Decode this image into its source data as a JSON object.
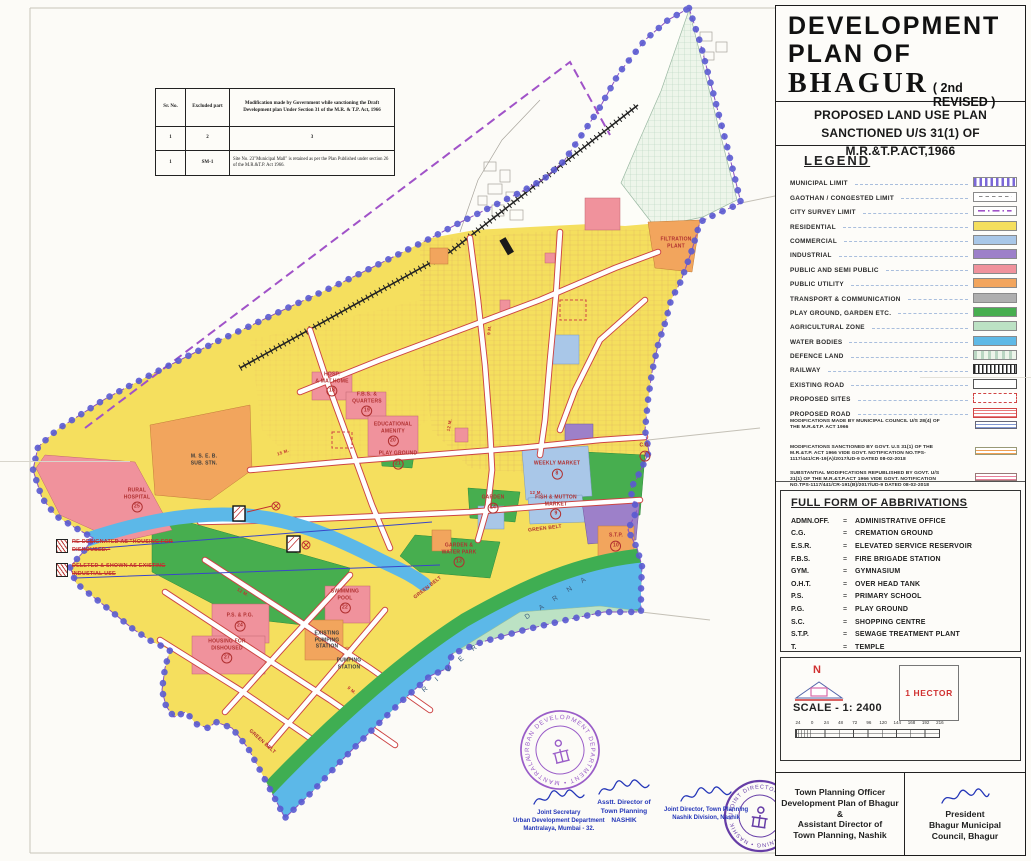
{
  "title_block": {
    "line1": "DEVELOPMENT",
    "line2": "PLAN  OF",
    "name": "BHAGUR",
    "revision": "( 2nd REVISED )",
    "subtitle1": "PROPOSED  LAND USE PLAN",
    "subtitle2": "SANCTIONED U/S 31(1) OF M.R.&T.P.ACT,1966"
  },
  "legend": {
    "title": "LEGEND",
    "items": [
      {
        "label": "MUNICIPAL LIMIT",
        "swatch": "municipal"
      },
      {
        "label": "GAOTHAN / CONGESTED LIMIT",
        "swatch": "gaothan"
      },
      {
        "label": "CITY SURVEY  LIMIT",
        "swatch": "survey"
      },
      {
        "label": "RESIDENTIAL",
        "swatch": "fill",
        "color": "#f5df5e"
      },
      {
        "label": "COMMERCIAL",
        "swatch": "fill",
        "color": "#a9c7e8"
      },
      {
        "label": "INDUSTRIAL",
        "swatch": "fill",
        "color": "#9d80c9"
      },
      {
        "label": "PUBLIC AND SEMI PUBLIC",
        "swatch": "fill",
        "color": "#f0929c"
      },
      {
        "label": "PUBLIC  UTILITY",
        "swatch": "fill",
        "color": "#f2a55d"
      },
      {
        "label": "TRANSPORT &  COMMUNICATION",
        "swatch": "fill",
        "color": "#afafaf"
      },
      {
        "label": "PLAY GROUND, GARDEN ETC.",
        "swatch": "fill",
        "color": "#47ae4f"
      },
      {
        "label": "AGRICULTURAL  ZONE",
        "swatch": "fill",
        "color": "#bce2c4"
      },
      {
        "label": "WATER BODIES",
        "swatch": "fill",
        "color": "#5fb9e6"
      },
      {
        "label": "DEFENCE  LAND",
        "swatch": "defence"
      },
      {
        "label": "RAILWAY",
        "swatch": "railway"
      },
      {
        "label": "EXISTING ROAD",
        "swatch": "existing-road"
      },
      {
        "label": "PROPOSED SITES",
        "swatch": "proposed-sites"
      },
      {
        "label": "PROPOSED ROAD",
        "swatch": "proposed-road"
      },
      {
        "label": "MODIFICATIONS MADE BY MUNICIPAL COUNCIL U/S 28(4) OF THE M.R.&T.P. ACT 1966",
        "swatch": "mod-blue",
        "sz": "small"
      },
      {
        "label": "MODIFICATIONS SANCTIONED BY GOVT. U.S 31(1) OF THE M.R.&T.P. ACT 1966 VIDE GOVT. NOTIFICATION NO.TPS-1117/441/CR-19(A)/2017/UD-9 DATED 08-02-2018",
        "swatch": "mod-orange",
        "sz": "small"
      },
      {
        "label": "SUBSTANTIAL MODIFICATIONS REPUBLISHED BY GOVT. U/S 31(1) OF THE M.R.&T.P.ACT 1966 VIDE GOVT. NOTIFICATION NO.TPS-1117/441/CR-191(B)/2017/UD-9 DATED 08-02-2018",
        "swatch": "mod-pink",
        "sz": "small"
      }
    ]
  },
  "abbreviations": {
    "title": "FULL FORM OF ABBRIVATIONS",
    "items": [
      {
        "abbr": "ADMN.OFF.",
        "eq": "=",
        "full": "ADMINISTRATIVE OFFICE"
      },
      {
        "abbr": "C.G.",
        "eq": "=",
        "full": "CREMATION GROUND"
      },
      {
        "abbr": "E.S.R.",
        "eq": "=",
        "full": "ELEVATED SERVICE RESERVOIR"
      },
      {
        "abbr": "F.B.S.",
        "eq": "=",
        "full": "FIRE BRIGADE STATION"
      },
      {
        "abbr": "GYM.",
        "eq": "=",
        "full": "GYMNASIUM"
      },
      {
        "abbr": "O.H.T.",
        "eq": "=",
        "full": "OVER HEAD TANK"
      },
      {
        "abbr": "P.S.",
        "eq": "=",
        "full": "PRIMARY SCHOOL"
      },
      {
        "abbr": "P.G.",
        "eq": "=",
        "full": "PLAY GROUND"
      },
      {
        "abbr": "S.C.",
        "eq": "=",
        "full": "SHOPPING CENTRE"
      },
      {
        "abbr": "S.T.P.",
        "eq": "=",
        "full": "SEWAGE TREATMENT PLANT"
      },
      {
        "abbr": "T.",
        "eq": "=",
        "full": "TEMPLE"
      }
    ]
  },
  "scale_block": {
    "north_label": "N",
    "scale_text": "SCALE - 1: 2400",
    "hector_label": "1 HECTOR",
    "bar_numbers": [
      "24",
      "0",
      "24",
      "48",
      "72",
      "96",
      "120",
      "144",
      "168",
      "192",
      "216"
    ]
  },
  "officials": {
    "left_lines": [
      "Town Planning Officer",
      "Development Plan of Bhagur",
      "&",
      "Assistant Director of",
      "Town Planning, Nashik"
    ],
    "right_lines": [
      "President",
      "Bhagur  Municipal",
      "Council, Bhagur"
    ]
  },
  "sig_blocks": [
    {
      "l1": "Joint Secretary",
      "l2": "Urban Development Department",
      "l3": "Mantralaya, Mumbai - 32.",
      "left": "513px",
      "top": "788px"
    },
    {
      "l1": "Asstt. Director of",
      "l2": "Town Planning",
      "l3": "NASHIK",
      "left": "596px",
      "top": "778px",
      "cls": "bold"
    },
    {
      "l1": "Joint Director, Town Planning",
      "l2": "Nashik Division, Nashik",
      "left": "664px",
      "top": "785px"
    }
  ],
  "stamps": {
    "upper_ring": "URBAN DEVELOPMENT DEPARTMENT • MANTRALAYA MUMBAI •",
    "lower_ring": "JOINT DIRECTOR OF TOWN PLANNING • NASHIK DIVISION NASHIK •"
  },
  "mod_table": {
    "headers": [
      "Sr. No.",
      "Excluded part",
      "Modification made by Government while sanctioning the Draft Development plan  Under Section 31  of the M.R. & T.P. Act, 1966"
    ],
    "rows": [
      [
        "1",
        "2",
        "3"
      ],
      [
        "1",
        "SM-1",
        "Site No. 23\"Municipal Mall\" is retained as per the Plan Published under section 26 of the M.R.&T.P. Act 1966."
      ]
    ]
  },
  "side_notes": [
    {
      "t": "RE-DESIGNATED AS \"HOUSING FOR DISHOUSED.\""
    },
    {
      "t": "DELETED & SHOWN AS EXISTING INDUSTIAL USE"
    }
  ],
  "map_labels": [
    {
      "t": "M. S. E. B.\nSUB. STN.",
      "left": "204px",
      "top": "460px",
      "cls": "dk"
    },
    {
      "t": "RURAL\nHOSPITAL",
      "n": "25",
      "left": "137px",
      "top": "500px"
    },
    {
      "t": "HOSP.\n& MAT.HOME",
      "n": "18",
      "left": "332px",
      "top": "384px"
    },
    {
      "t": "F.B.S. &\nQUARTERS",
      "n": "19",
      "left": "367px",
      "top": "404px"
    },
    {
      "t": "EDUCATIONAL\nAMENITY",
      "n": "20",
      "left": "393px",
      "top": "434px"
    },
    {
      "t": "PLAY GROUND",
      "n": "21",
      "left": "398px",
      "top": "460px"
    },
    {
      "t": "FILTRATION\nPLANT",
      "left": "676px",
      "top": "243px"
    },
    {
      "t": "WEEKLY MARKET",
      "n": "8",
      "left": "557px",
      "top": "470px"
    },
    {
      "t": "FISH & MUTTON\nMARKET",
      "n": "9",
      "left": "556px",
      "top": "507px"
    },
    {
      "t": "GARDEN",
      "n": "14",
      "left": "493px",
      "top": "504px"
    },
    {
      "t": "GARDEN &\nWATER PARK",
      "n": "13",
      "left": "459px",
      "top": "555px"
    },
    {
      "t": "GREEN BELT",
      "left": "545px",
      "top": "529px",
      "tr": "translate(-50%,-50%) rotate(-7deg)"
    },
    {
      "t": "GREEN  BELT",
      "left": "428px",
      "top": "588px",
      "tr": "translate(-50%,-50%) rotate(-38deg)"
    },
    {
      "t": "GREEN BELT",
      "left": "262px",
      "top": "742px",
      "tr": "translate(-50%,-50%) rotate(42deg)"
    },
    {
      "t": "S.T.P.",
      "n": "10",
      "left": "616px",
      "top": "542px"
    },
    {
      "t": "C.G.",
      "n": "7",
      "left": "645px",
      "top": "452px"
    },
    {
      "t": "SWIMMING\nPOOL",
      "n": "22",
      "left": "345px",
      "top": "601px"
    },
    {
      "t": "P.S. & P.G.",
      "n": "24",
      "left": "240px",
      "top": "622px"
    },
    {
      "t": "HOUSING FOR\nDISHOUSED",
      "n": "27",
      "left": "227px",
      "top": "651px"
    },
    {
      "t": "EXISTING\nPUMPING\nSTATION",
      "left": "327px",
      "top": "640px",
      "cls": "dk"
    },
    {
      "t": "PUMPING\nSTATION",
      "left": "349px",
      "top": "664px",
      "cls": "dk"
    },
    {
      "t": "D A R N A",
      "left": "558px",
      "top": "598px",
      "tr": "translate(-50%,-50%) rotate(-33deg)",
      "cls": "river"
    },
    {
      "t": "R I V E R",
      "left": "452px",
      "top": "668px",
      "tr": "translate(-50%,-50%) rotate(-40deg)",
      "cls": "river"
    },
    {
      "t": "12 M.",
      "left": "449px",
      "top": "425px",
      "tr": "translate(-50%,-50%) rotate(-80deg)",
      "cls": "rw"
    },
    {
      "t": "9 M.",
      "left": "489px",
      "top": "330px",
      "tr": "translate(-50%,-50%) rotate(-83deg)",
      "cls": "rw"
    },
    {
      "t": "12 M.",
      "left": "536px",
      "top": "492px",
      "cls": "rw"
    },
    {
      "t": "15 M.",
      "left": "283px",
      "top": "452px",
      "tr": "translate(-50%,-50%) rotate(-18deg)",
      "cls": "rw"
    },
    {
      "t": "12 M.",
      "left": "243px",
      "top": "592px",
      "tr": "translate(-50%,-50%) rotate(30deg)",
      "cls": "rw"
    },
    {
      "t": "9 M.",
      "left": "352px",
      "top": "690px",
      "tr": "translate(-50%,-50%) rotate(40deg)",
      "cls": "rw"
    }
  ],
  "colors": {
    "residential": "#f5df5e",
    "water": "#5fb9e6",
    "green": "#47ae4f",
    "agriculture": "#bce2c4",
    "public_semi_public": "#f0929c",
    "public_utility": "#f2a55d",
    "industrial": "#9d80c9",
    "boundary_purple": "#5a5ad0",
    "survey_purple": "#a052c8",
    "road_edge_red": "#cc4444",
    "stamp_purple": "#7a3fb5",
    "signature_blue": "#2436b8"
  }
}
